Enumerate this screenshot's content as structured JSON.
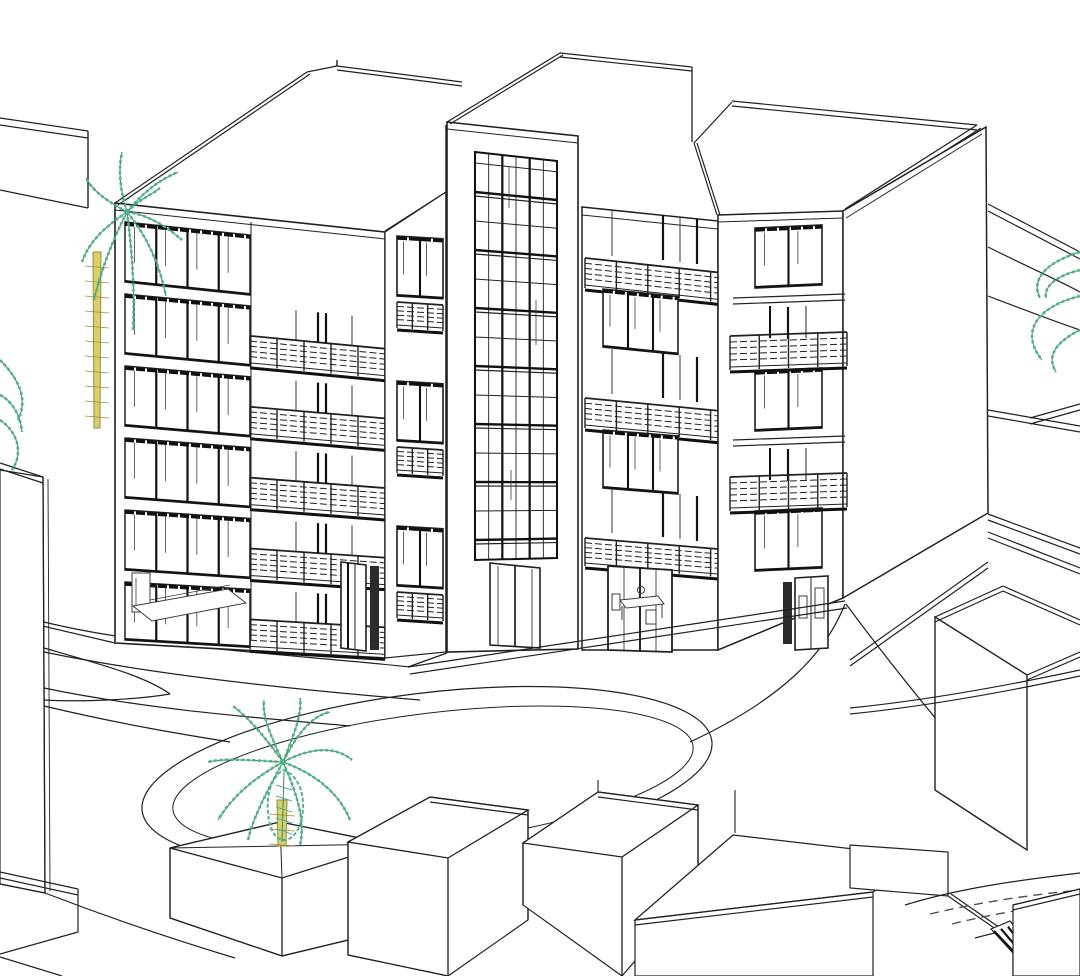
{
  "app": {
    "title": "3D architectural model view"
  },
  "colors": {
    "background": "#ffffff",
    "line": "#212121",
    "line_soft": "#3c3c3c",
    "heavy": "#111111",
    "glass_dark": "#2b2b2b",
    "palm_green": "#55b187",
    "palm_green_dark": "#2e8f68",
    "trunk_fill": "#d9d06c",
    "trunk_line": "#968f3e",
    "dash_gray": "#4f4f4f"
  },
  "scene": {
    "main_building": {
      "name": "five-to-six storey apartment block with balconies",
      "left_block": {
        "floors": 6,
        "window_columns": 4,
        "balconies": 5,
        "ground_floor_furniture": "bed",
        "ground_floor_door": true
      },
      "stair_tower": {
        "glazing_columns": 3,
        "entrance": "double glass door"
      },
      "middle_wing": {
        "balconies": 3,
        "window_columns": 3,
        "door_rows": 3,
        "ground_floor_furniture": "dining table with chairs"
      },
      "right_block": {
        "floors": 5,
        "window_rows": 3,
        "balconies": 2,
        "ground_floor_door": true
      }
    },
    "palm_trees": [
      {
        "id": "palm-upper-left",
        "position": "behind left block, upper left"
      },
      {
        "id": "palm-forecourt",
        "position": "courtyard, bottom centre"
      },
      {
        "id": "palm-left-edge",
        "position": "partial fronds, left edge"
      },
      {
        "id": "palm-right-edge",
        "position": "partial fronds, right edge"
      }
    ],
    "site": {
      "driveway": "oval loop with double curb line",
      "street": "bottom-right street with dashed lane markings and hatched ramp",
      "background_buildings": 4,
      "foreground_buildings": 7
    }
  }
}
